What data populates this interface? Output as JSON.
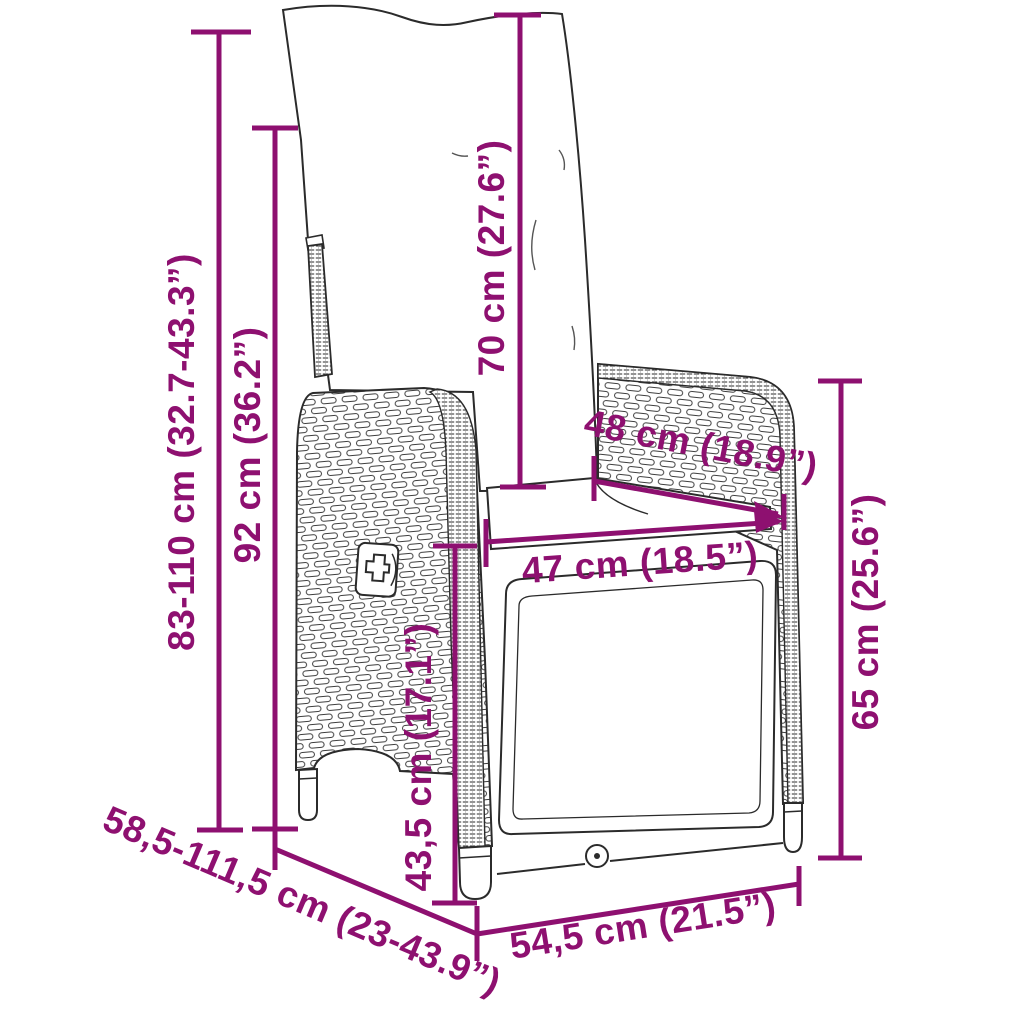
{
  "diagram": {
    "subject": "reclining-garden-wicker-chair-dimension-drawing",
    "accent_color": "#8E1070",
    "line_color": "#2b2b2b",
    "background_color": "#ffffff",
    "dimensions": [
      {
        "id": "height-range",
        "label": "83-110 cm (32.7-43.3”)",
        "orientation": "vertical"
      },
      {
        "id": "backrest-height",
        "label": "92 cm (36.2”)",
        "orientation": "vertical"
      },
      {
        "id": "cushion-height",
        "label": "70 cm (27.6”)",
        "orientation": "vertical"
      },
      {
        "id": "armrest-depth",
        "label": "48 cm (18.9”)",
        "orientation": "diagonal"
      },
      {
        "id": "seat-width",
        "label": "47 cm (18.5”)",
        "orientation": "horizontal"
      },
      {
        "id": "armrest-height",
        "label": "65 cm (25.6”)",
        "orientation": "vertical"
      },
      {
        "id": "seat-height",
        "label": "43,5 cm (17.1”)",
        "orientation": "vertical"
      },
      {
        "id": "depth-range",
        "label": "58,5-111,5 cm (23-43.9”)",
        "orientation": "diagonal"
      },
      {
        "id": "base-width",
        "label": "54,5 cm (21.5”)",
        "orientation": "diagonal"
      }
    ]
  }
}
